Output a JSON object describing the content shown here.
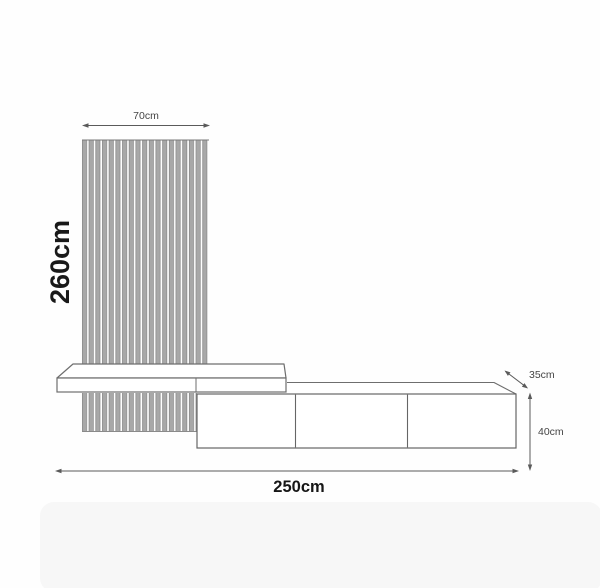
{
  "diagram": {
    "title": "wall-unit-dimension-diagram",
    "labels": {
      "panel_width": "70cm",
      "panel_height": "260cm",
      "cabinet_depth": "35cm",
      "cabinet_height": "40cm",
      "total_width": "250cm"
    },
    "structure": {
      "slat_panel": {
        "slat_count": 19
      },
      "shelf": {
        "segments": 2
      },
      "cabinet": {
        "door_count": 3
      }
    },
    "colors": {
      "outline": "#6e6e6e",
      "dimension_line": "#5a5a5a",
      "slat_fill": "#a8a8a8",
      "slat_edge": "#6f6f6f",
      "label_small": "#454545",
      "label_dark": "#161616",
      "background": "#fefefe",
      "bottom_panel": "#f7f7f7"
    }
  }
}
